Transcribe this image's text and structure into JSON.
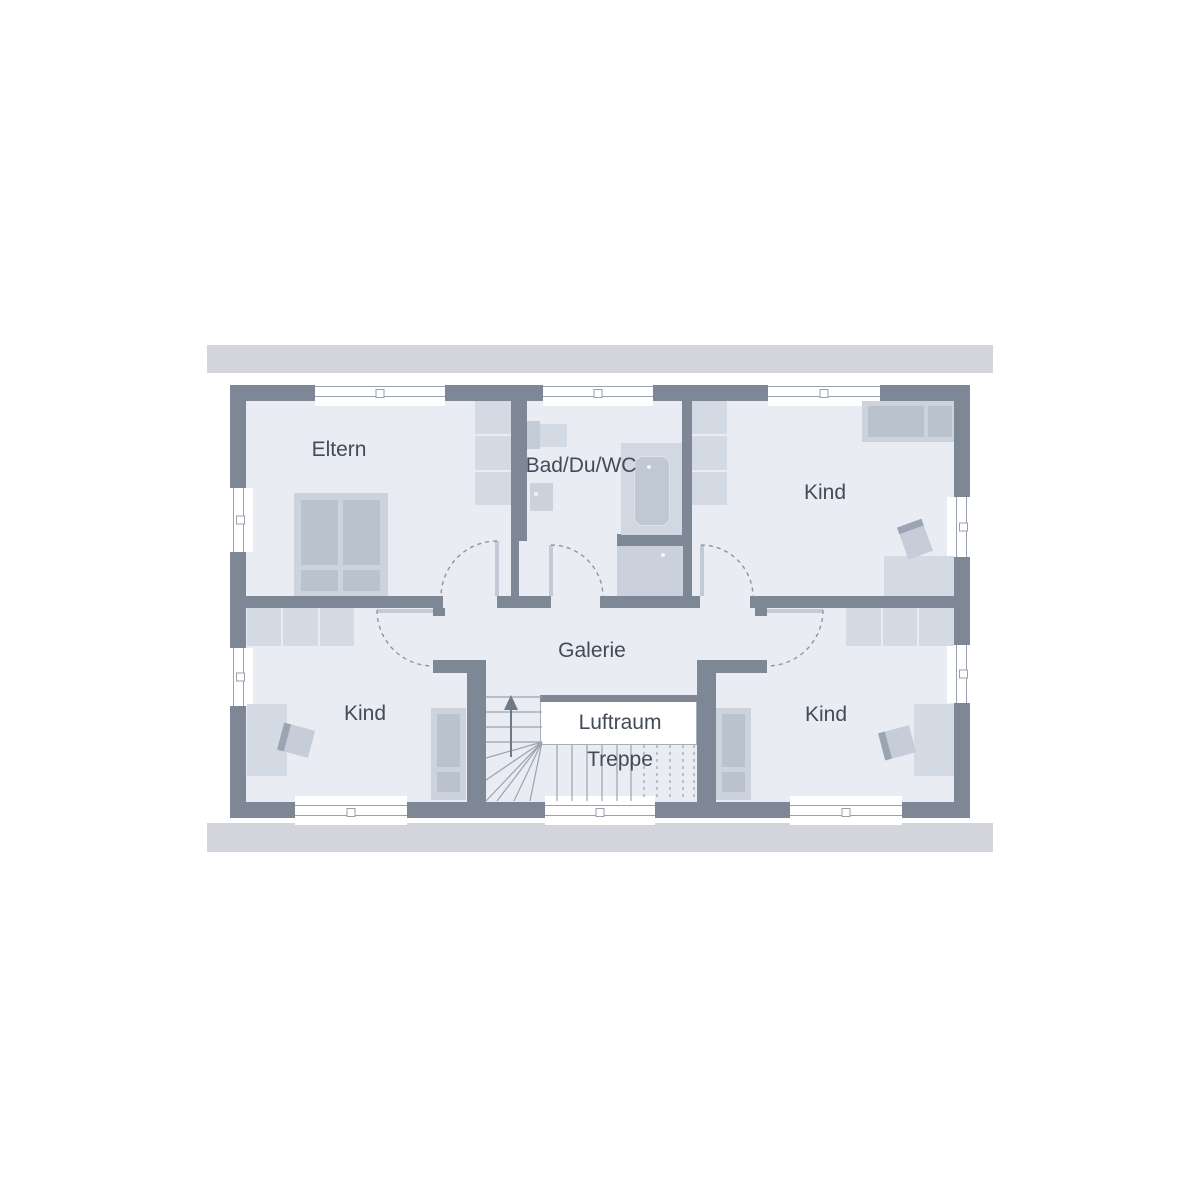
{
  "plan": {
    "type": "floor-plan",
    "rooms": [
      {
        "key": "eltern",
        "label": "Eltern",
        "furniture": [
          "double-bed",
          "wardrobe"
        ]
      },
      {
        "key": "bad-du-wc",
        "label": "Bad/Du/WC",
        "furniture": [
          "washbasin",
          "toilet",
          "bathtub",
          "shower"
        ]
      },
      {
        "key": "kind-top-right",
        "label": "Kind",
        "furniture": [
          "bed",
          "wardrobe",
          "desk",
          "chair"
        ]
      },
      {
        "key": "galerie",
        "label": "Galerie",
        "furniture": []
      },
      {
        "key": "kind-bottom-left",
        "label": "Kind",
        "furniture": [
          "bed",
          "wardrobe",
          "desk",
          "chair"
        ]
      },
      {
        "key": "kind-bottom-right",
        "label": "Kind",
        "furniture": [
          "bed",
          "wardrobe",
          "desk",
          "chair"
        ]
      },
      {
        "key": "luftraum",
        "label": "Luftraum",
        "furniture": []
      },
      {
        "key": "treppe",
        "label": "Treppe",
        "furniture": [
          "staircase",
          "up-arrow"
        ]
      }
    ],
    "colors": {
      "wall": "#7d8795",
      "floor": "#e9ecf2",
      "roof_band": "#d3d4dc",
      "furniture_light": "#d4dae3",
      "furniture_dark": "#b9c2cd",
      "line": "#98a1ae",
      "void": "#ffffff",
      "text": "#414b59"
    }
  }
}
